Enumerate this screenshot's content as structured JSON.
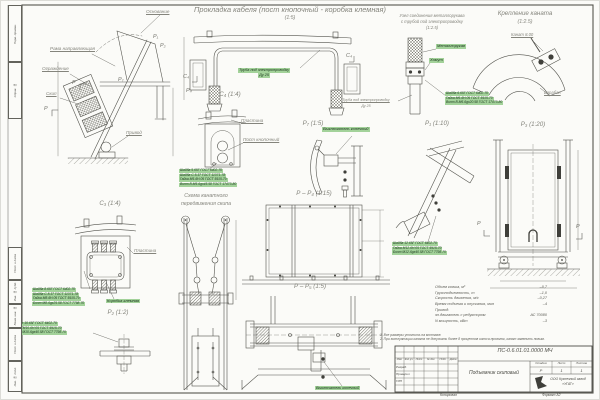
{
  "colors": {
    "paper": "#fbfbf8",
    "line": "#53534d",
    "label_gray": "#84847c",
    "highlight_bg": "#a3d29a",
    "highlight_text": "#17331a"
  },
  "header": {
    "main_title": "Прокладка кабеля (пост кнопочный - коробка клемная)",
    "main_scale": "(1:5)"
  },
  "views": {
    "side": {
      "labels": {
        "osnovanie": "Основание",
        "rama": "Рама направляющая",
        "ograzhdenie": "Ограждение",
        "skip": "Скип",
        "privod": "Привод"
      },
      "markers": {
        "p1": "Р₁",
        "p2": "Р₂",
        "p7": "Р₇",
        "p_a": "Р",
        "p_b": "Р"
      }
    },
    "cable_frame": {
      "pipe_label_line1": "Труба под электропроводку",
      "pipe_label_line2": "Ду 25",
      "marker_c4_left": "С₄",
      "marker_c4_right": "С₄",
      "marker_p4": "Р₄"
    },
    "sleeve": {
      "title_line1": "Узел соединения металлорукава",
      "title_line2": "с трубой под электропроводку",
      "scale": "(1:2.5)",
      "label_sleeve": "Металлорукав",
      "label_clamp": "Хомут",
      "pipe_label_line1": "Труба под электропроводку",
      "pipe_label_line2": "Ду 25",
      "callout": [
        "Шайба 6.65Г ГОСТ 6402-70",
        "Гайка М6-6Н.05 ГОСТ 5915-70",
        "Винт В.М6-6gх20.58 ГОСТ 17473-80"
      ]
    },
    "rope_fix": {
      "title": "Крепление каната",
      "scale": "(1:2.5)",
      "label_rope": "Канат 8.00",
      "label_drum": "Барабан"
    },
    "c4": {
      "title": "С₄ (1:4)",
      "label_plate": "Пластина",
      "label_post": "Пост кнопочный",
      "callout": [
        "Шайба 5.65Г ГОСТ 6402-70",
        "Шайба С.5.37 ГОСТ 11371-78",
        "Гайка М5-6Н.05 ГОСТ 5915-70",
        "Винт В.М5-6gх45.58 ГОСТ 17473-80"
      ]
    },
    "p7": {
      "title": "Р₇ (1:5)",
      "label_switch": "Выключатель конечный"
    },
    "scheme": {
      "title_line1": "Схема канатного",
      "title_line2": "передвижения скипа"
    },
    "pp4": {
      "title": "Р – Р₄ (1:15)"
    },
    "pp5": {
      "title": "Р – Р₅ (1:5)",
      "label_switch": "Выключатель конечный"
    },
    "c3": {
      "title": "С₃ (1:4)",
      "label_plate": "Пластина",
      "label_box": "Коробка клемная",
      "callout": [
        "Шайба 8.65Г ГОСТ 6402-70",
        "Шайба С.8.37 ГОСТ 11371-78",
        "Гайка М8-6Н.05 ГОСТ 5915-70",
        "Болт М8-6gх25.58 ГОСТ 7798-70"
      ]
    },
    "p2": {
      "title": "Р₂ (1:2)",
      "callout": [
        "Шайба 10.65Г ГОСТ 6402-70",
        "Гайка М10-6Н.05 ГОСТ 5915-70",
        "Болт М10-6gх40.58 ГОСТ 7798-70"
      ]
    },
    "p1": {
      "title": "Р₁ (1:10)",
      "callout": [
        "Шайба 12.65Г ГОСТ 6402-70",
        "Гайка М12-6Н.05 ГОСТ 5915-70",
        "Болт М12-6gх40.58 ГОСТ 7798-70"
      ]
    },
    "p3": {
      "title": "Р₃ (1:20)",
      "marker_left": "Р",
      "marker_right": "Р"
    }
  },
  "specs": {
    "rows": [
      {
        "name": "Объем ковша, м³",
        "value": "–0,7"
      },
      {
        "name": "Грузоподъемность, т",
        "value": "–1,0"
      },
      {
        "name": "Скорость движения, м/с",
        "value": "–0,27"
      },
      {
        "name": "Время подъема и опускания, мин",
        "value": "–4"
      },
      {
        "name": "Привод:",
        "value": ""
      },
      {
        "name": "эл.двигатель с редуктором",
        "value": "АС 70080"
      },
      {
        "name": "N мощность, кВт",
        "value": "–3"
      }
    ]
  },
  "notes": {
    "line1": "1. Все размеры уточнить на монтаже.",
    "line2": "2. При эксплуатации каната не допускать более 8 процентов износа проволок, канат заменить новым."
  },
  "titleblock": {
    "doc_number": "ПС-0.6.01.01.0000 МЧ",
    "object_name": "Подъемник скиповый",
    "stage_label": "Стадия",
    "sheet_label": "Лист",
    "sheets_label": "Листов",
    "stage": "Р",
    "sheet": "1",
    "sheets": "1",
    "company_line1": "ООО Кузнечный завод",
    "company_line2": "«УГАТ»",
    "cols": [
      "Изм.",
      "Кол.уч.",
      "Лист",
      "№ док.",
      "Подп.",
      "Дата"
    ],
    "rows": [
      "Разраб.",
      "Проверил",
      "ГИП"
    ],
    "footer_copy": "Копировал",
    "footer_format": "Формат А2"
  },
  "side_stamp": [
    "Перв. примен.",
    "Справ. №",
    "Подп. и дата",
    "Инв. № дубл.",
    "Взам. инв. №",
    "Подп. и дата",
    "Инв. № подл."
  ]
}
